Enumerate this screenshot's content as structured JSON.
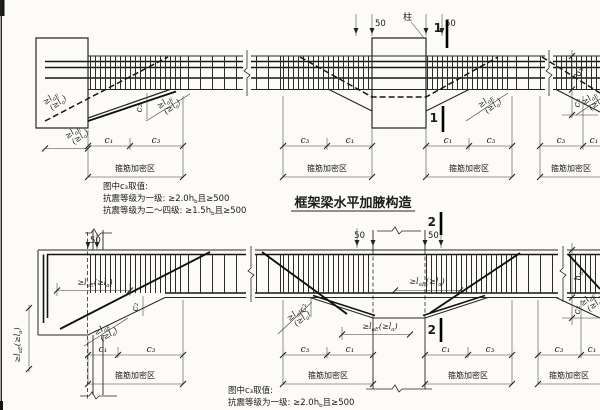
{
  "colors": {
    "ink": "#222222",
    "paper": "#fcfbf7"
  },
  "title": "框架梁水平加腋构造",
  "labels": {
    "column": "柱",
    "n50": "50",
    "s1": "1",
    "s2": "2",
    "c1": "c₁",
    "c2": "c₂",
    "c3": "c₃",
    "zone": "箍筋加密区",
    "bb": {
      "m": "b",
      "s": "b"
    },
    "hb": {
      "m": "h",
      "s": "b"
    },
    "anc": {
      "m1": "≥l",
      "s1": "aE",
      "m2": "(≥l",
      "s2": "a",
      "m3": ")"
    }
  },
  "notes_top": {
    "l1": "图中c₃取值:",
    "l2_pre": "抗震等级为一级: ≥2.0h",
    "l2_sub": "b",
    "l2_post": "且≥500",
    "l3_pre": "抗震等级为二～四级: ≥1.5h",
    "l3_sub": "b",
    "l3_post": "且≥500"
  },
  "notes_bottom": {
    "l1": "图中c₃取值:",
    "l2_pre": "抗震等级为一级: ≥2.0h",
    "l2_sub": "b",
    "l2_post": "且≥500"
  }
}
